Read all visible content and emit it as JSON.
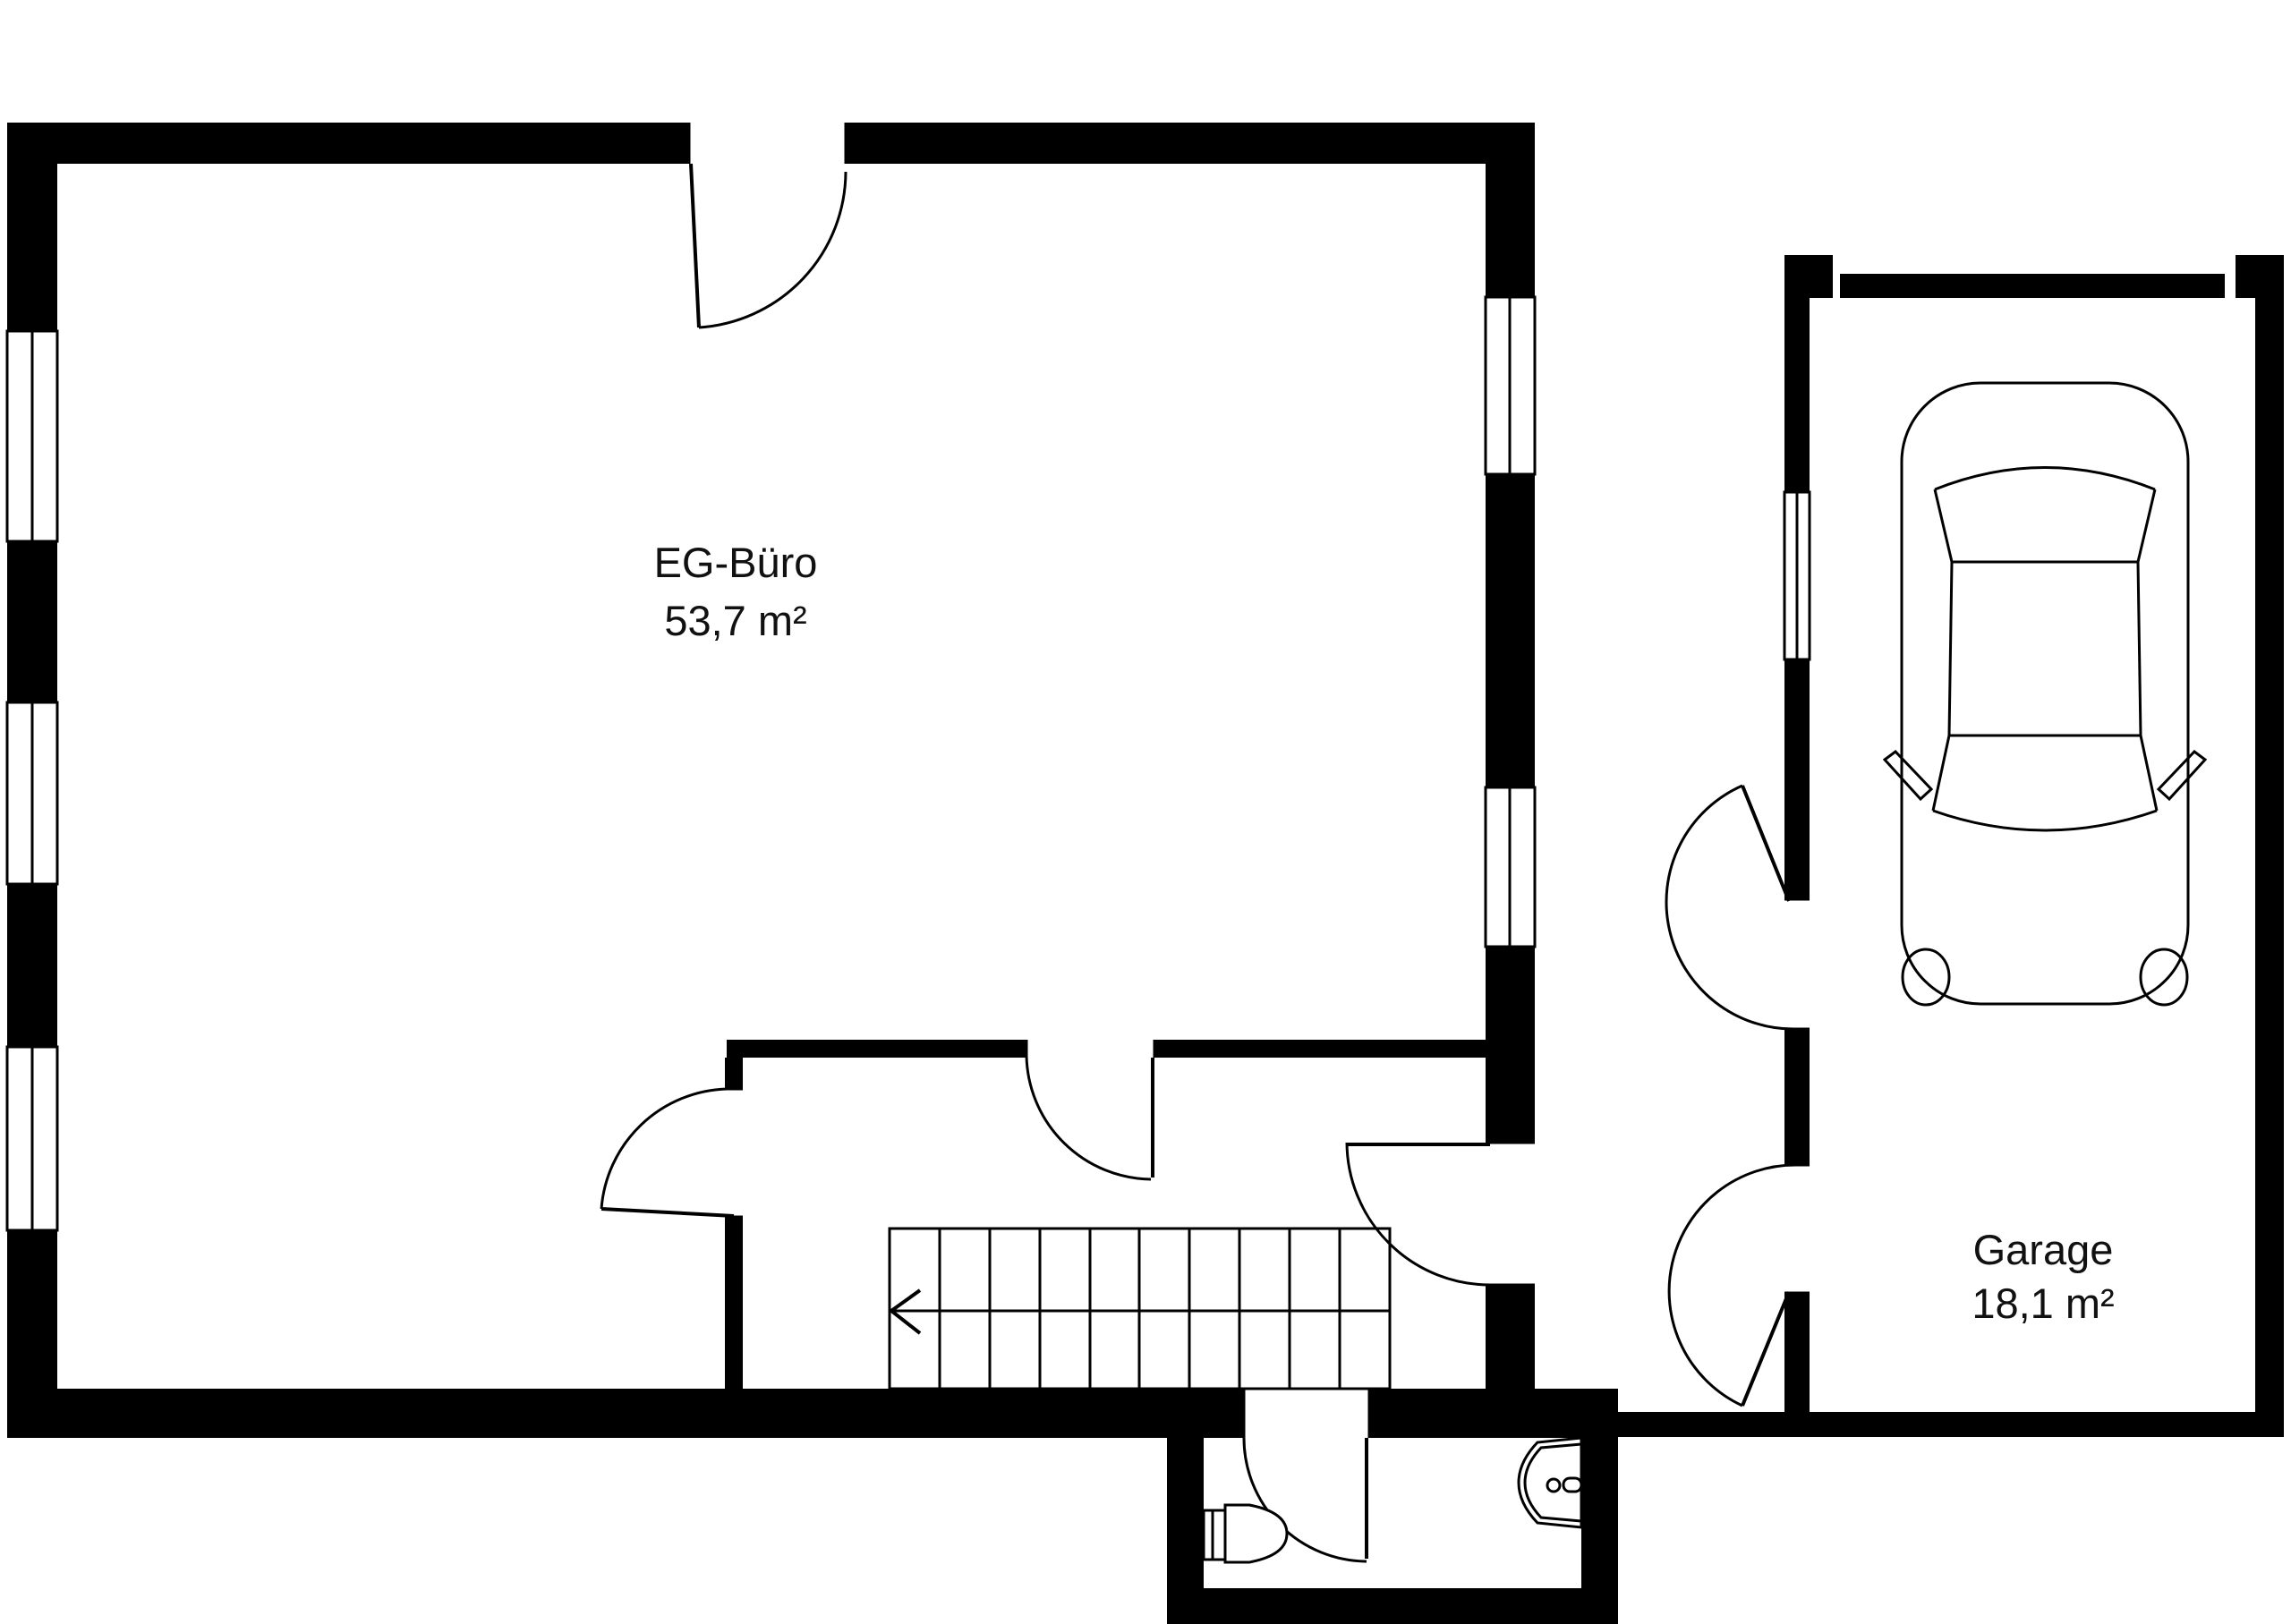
{
  "plan": {
    "colors": {
      "wall": "#000000",
      "background": "#ffffff",
      "text": "#111111"
    },
    "rooms": [
      {
        "id": "eg-buero",
        "label": "EG-Büro",
        "area": "53,7 m²"
      },
      {
        "id": "garage",
        "label": "Garage",
        "area": "18,1 m²"
      }
    ],
    "stairs": {
      "runs": 2,
      "treads_per_run": 10,
      "arrow_direction": "left"
    },
    "icons": [
      "staircase-icon",
      "stair-direction-arrow-icon",
      "car-icon",
      "toilet-icon",
      "washbasin-icon",
      "door-swing-icon",
      "window-icon",
      "garage-door-icon"
    ]
  }
}
